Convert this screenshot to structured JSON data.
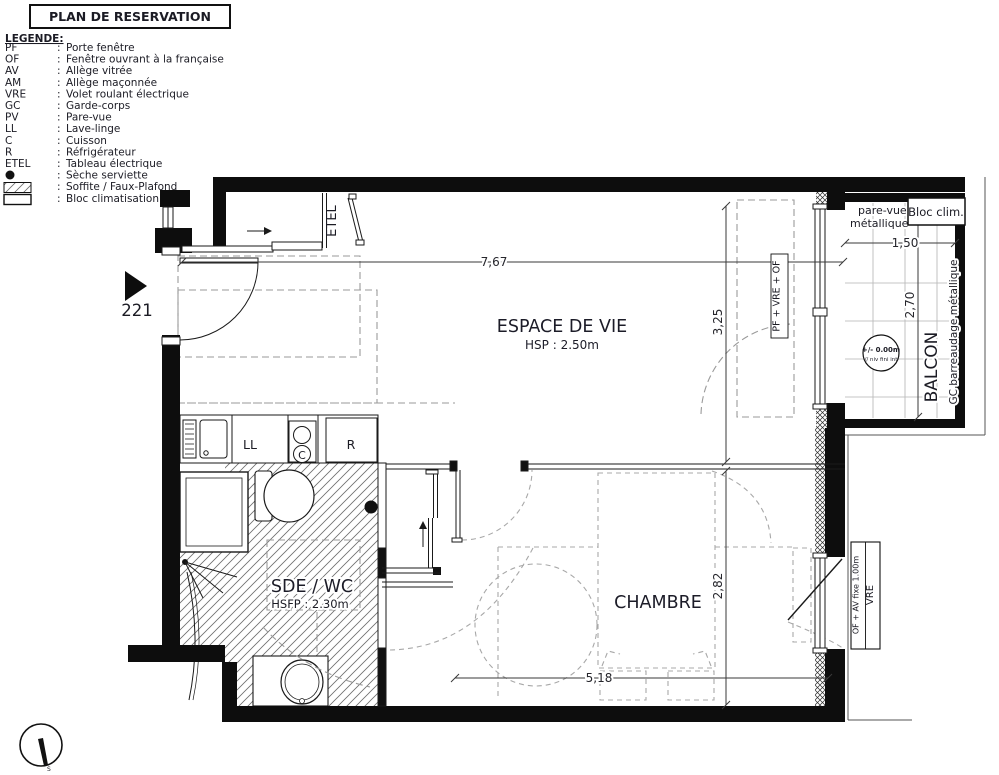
{
  "title": "PLAN DE RESERVATION",
  "unit": {
    "number": "221"
  },
  "legend": {
    "heading": "LEGENDE:",
    "colon": ":",
    "items": [
      {
        "abbr": "PF",
        "label": "Porte fenêtre"
      },
      {
        "abbr": "OF",
        "label": "Fenêtre ouvrant à la française"
      },
      {
        "abbr": "AV",
        "label": "Allège vitrée"
      },
      {
        "abbr": "AM",
        "label": "Allège maçonnée"
      },
      {
        "abbr": "VRE",
        "label": "Volet roulant électrique"
      },
      {
        "abbr": "GC",
        "label": "Garde-corps"
      },
      {
        "abbr": "PV",
        "label": "Pare-vue"
      },
      {
        "abbr": "LL",
        "label": "Lave-linge"
      },
      {
        "abbr": "C",
        "label": "Cuisson"
      },
      {
        "abbr": "R",
        "label": "Réfrigérateur"
      },
      {
        "abbr": "ETEL",
        "label": "Tableau électrique"
      },
      {
        "abbr": "",
        "symbol": "dot",
        "label": "Sèche serviette"
      },
      {
        "abbr": "",
        "symbol": "hatch",
        "label": "Soffite / Faux-Plafond"
      },
      {
        "abbr": "",
        "symbol": "box",
        "label": "Bloc climatisation"
      }
    ]
  },
  "rooms": {
    "living": {
      "name": "ESPACE DE VIE",
      "ceiling": "HSP : 2.50m"
    },
    "bathroom": {
      "name": "SDE / WC",
      "ceiling": "HSFP : 2.30m"
    },
    "bedroom": {
      "name": "CHAMBRE"
    },
    "balcony": {
      "name": "BALCON",
      "railing": "GC barreaudage métallique"
    }
  },
  "appliances": {
    "washer": "LL",
    "cooktop": "C",
    "fridge": "R",
    "electrical_panel": "ETEL"
  },
  "windows": {
    "living_balcony": "PF + VRE + OF",
    "bedroom_line1": "OF + AV fixe 1.00m",
    "bedroom_line2": "VRE"
  },
  "balcony_annotations": {
    "pare_vue_line1": "pare-vue",
    "pare_vue_line2": "métallique",
    "bloc_clim": "Bloc clim.",
    "level": "+/- 0.00m",
    "level_note": "// niv fini int"
  },
  "dimensions": {
    "living_width": "7,67",
    "living_depth": "3,25",
    "bedroom_width": "5,18",
    "bedroom_depth": "2,82",
    "balcony_width": "1,50",
    "balcony_depth": "2,70"
  },
  "compass": {
    "label": "S"
  },
  "colors": {
    "wall": "#0d0d0d",
    "line": "#1a1a1a",
    "dashed": "#9a9a9a",
    "text": "#1b1b24"
  }
}
